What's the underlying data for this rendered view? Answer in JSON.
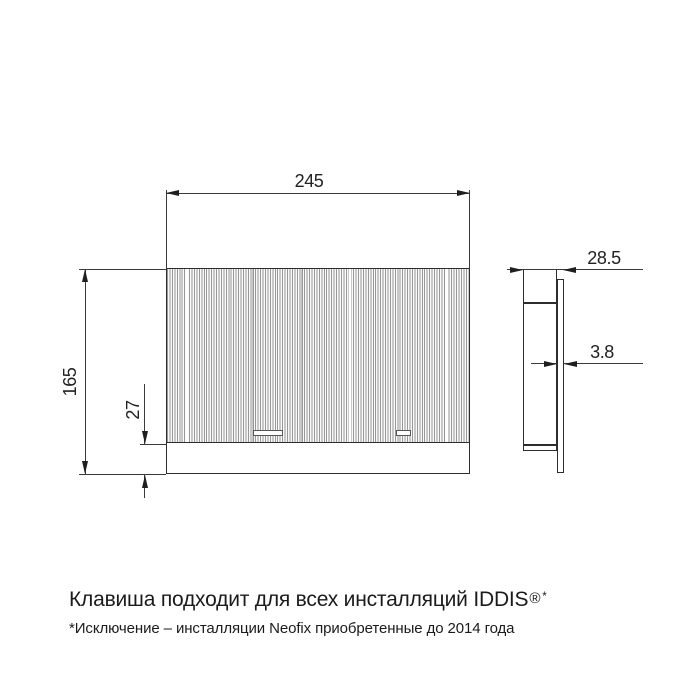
{
  "drawing": {
    "front_view": {
      "width_label": "245",
      "height_label": "165",
      "bottom_height_label": "27"
    },
    "side_view": {
      "depth_label": "28.5",
      "thickness_label": "3.8"
    }
  },
  "caption": {
    "title": "Клавиша подходит для всех инсталляций IDDIS",
    "reg": "®",
    "star": "*",
    "footnote": "*Исключение – инсталляции Neofix приобретенные до 2014 года"
  },
  "colors": {
    "background": "#ffffff",
    "outline": "#2d2d2d",
    "dimension_line": "#3a3a3a",
    "arrow": "#1f1f1f",
    "hatch_line": "#979797",
    "text": "#1b1b1b"
  }
}
